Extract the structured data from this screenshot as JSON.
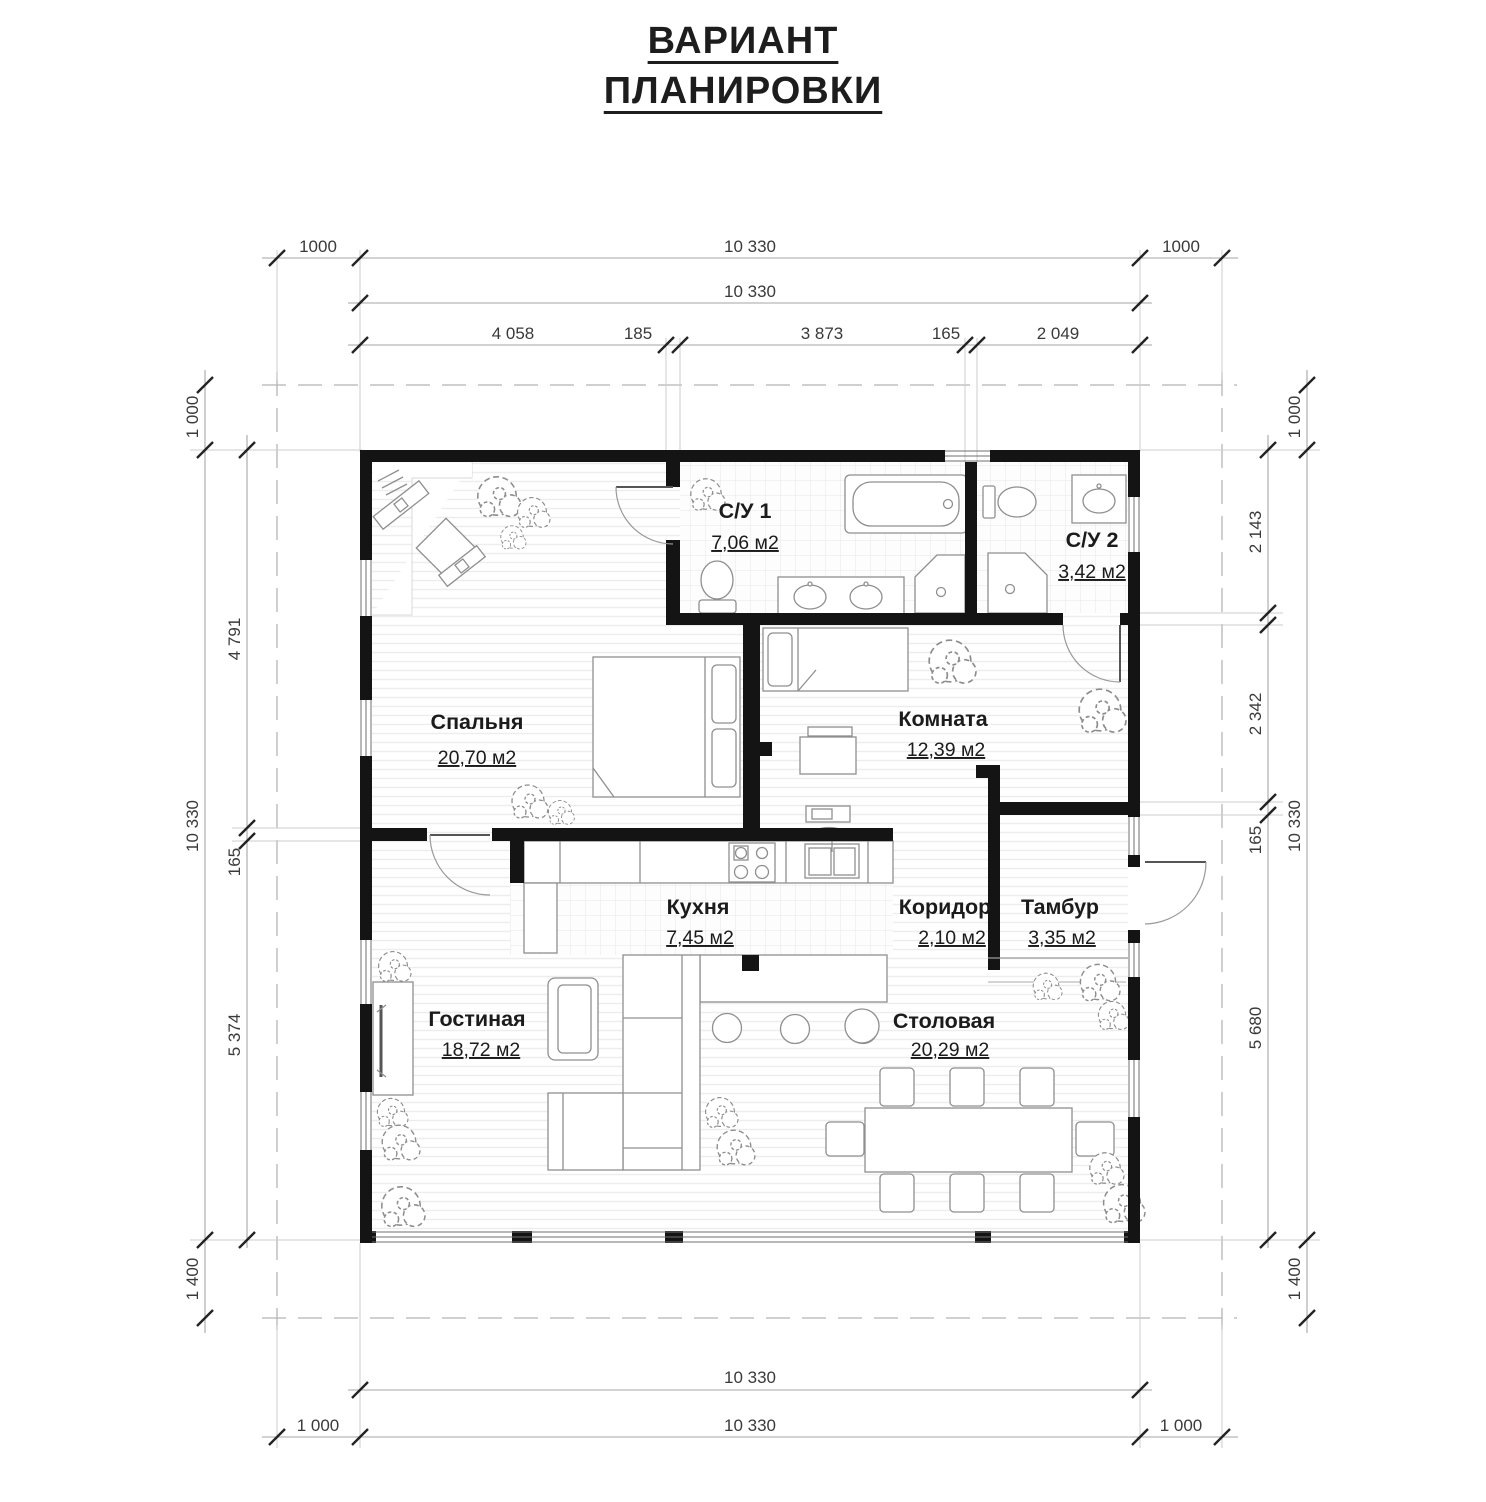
{
  "title": {
    "line1": "ВАРИАНТ",
    "line2": "ПЛАНИРОВКИ"
  },
  "rooms": [
    {
      "name": "Спальня",
      "area": "20,70 м2"
    },
    {
      "name": "С/У 1",
      "area": "7,06 м2"
    },
    {
      "name": "С/У 2",
      "area": "3,42 м2"
    },
    {
      "name": "Комната",
      "area": "12,39 м2"
    },
    {
      "name": "Кухня",
      "area": "7,45 м2"
    },
    {
      "name": "Коридор",
      "area": "2,10 м2"
    },
    {
      "name": "Тамбур",
      "area": "3,35 м2"
    },
    {
      "name": "Гостиная",
      "area": "18,72 м2"
    },
    {
      "name": "Столовая",
      "area": "20,29 м2"
    }
  ],
  "dimensions": {
    "top_row1": [
      "1000",
      "10 330",
      "1000"
    ],
    "top_row2": [
      "10 330"
    ],
    "top_row3": [
      "4 058",
      "185",
      "3 873",
      "165",
      "2 049"
    ],
    "left_outer": [
      "1 000",
      "10 330",
      "1 400"
    ],
    "left_inner": [
      "4 791",
      "165",
      "5 374"
    ],
    "right_inner": [
      "2 143",
      "2 342",
      "165",
      "5 680"
    ],
    "right_outer": [
      "1 000",
      "10 330",
      "1 400"
    ],
    "bottom_row1": [
      "10 330"
    ],
    "bottom_row2": [
      "1 000",
      "10 330",
      "1 000"
    ]
  },
  "colors": {
    "wall": "#141414",
    "dim_line": "#a6a6a6",
    "furniture": "#8f8f8f"
  }
}
